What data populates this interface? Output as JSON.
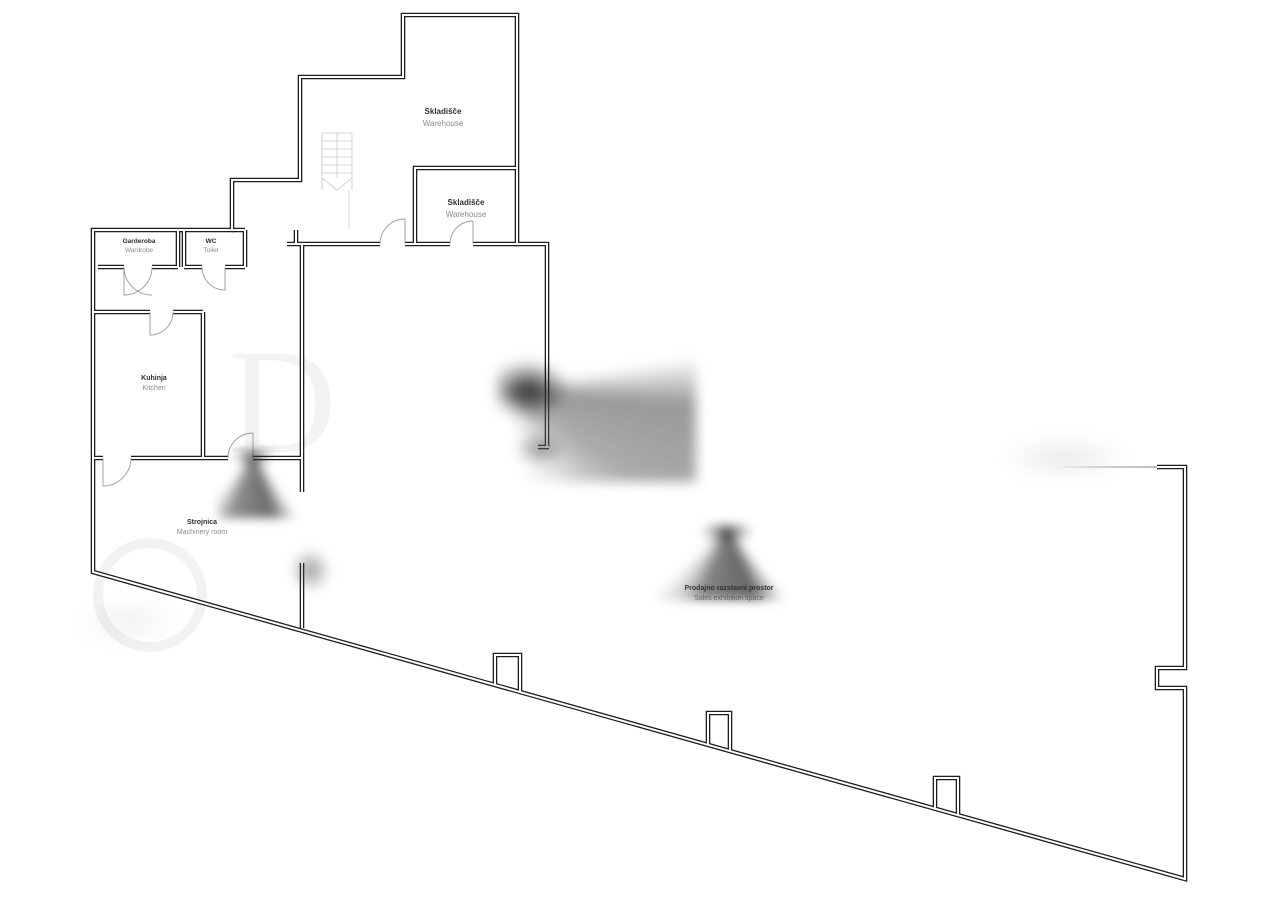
{
  "colors": {
    "wall": "#1f1f1f",
    "door_arc": "#9a9a9a",
    "stairs": "#c6c6c6",
    "label_primary": "#2f2f2f",
    "label_secondary": "#8a8a8a",
    "background": "#ffffff"
  },
  "rooms": [
    {
      "id": "warehouse-main",
      "sl": "Skladišče",
      "en": "Warehouse"
    },
    {
      "id": "warehouse-small",
      "sl": "Skladišče",
      "en": "Warehouse"
    },
    {
      "id": "wardrobe",
      "sl": "Garderoba",
      "en": "Wardrobe"
    },
    {
      "id": "toilet",
      "sl": "WC",
      "en": "Toilet"
    },
    {
      "id": "kitchen",
      "sl": "Kuhinja",
      "en": "Kitchen"
    },
    {
      "id": "machinery",
      "sl": "Strojnica",
      "en": "Machinery room"
    },
    {
      "id": "sales",
      "sl": "Prodajno razstavni prostor",
      "en": "Sales exhibition space"
    }
  ]
}
